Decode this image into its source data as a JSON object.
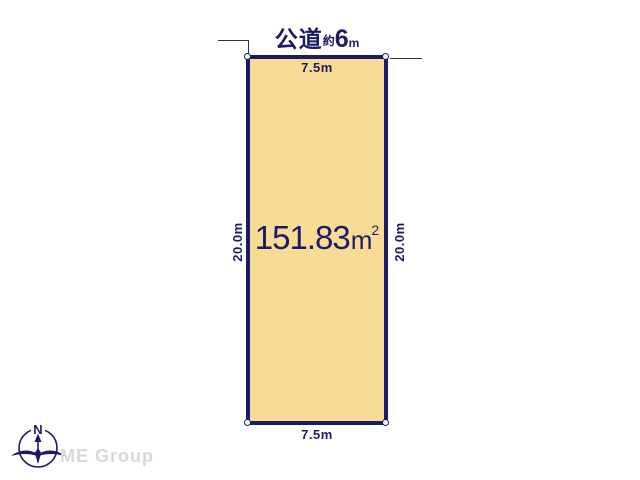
{
  "diagram": {
    "road_front": {
      "name": "公道",
      "approx": "約",
      "width": "6",
      "unit": "m"
    },
    "parcel": {
      "area_value": "151.83",
      "area_unit": "m",
      "area_exponent": "2",
      "width_top": "7.5m",
      "width_bottom": "7.5m",
      "depth_left": "20.0m",
      "depth_right": "20.0m"
    },
    "compass": {
      "north": "N"
    },
    "watermark": "ME Group",
    "colors": {
      "parcel_fill": "#F8DC96",
      "line_navy": "#1C1C66",
      "watermark_gray": "#D8D8D8"
    }
  }
}
